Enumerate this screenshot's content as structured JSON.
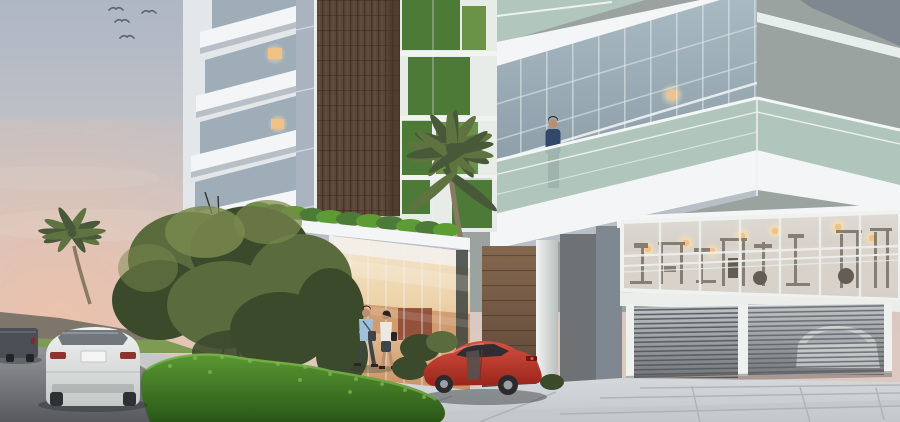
{
  "scene": {
    "type": "architectural-render",
    "setting": "modern residential building exterior at dusk",
    "objects": [
      "sky",
      "birds",
      "white-balcony-tower",
      "wood-clad-tower",
      "vertical-garden-panels",
      "glass-curtain-wall",
      "green-glass-balconies",
      "man-on-balcony",
      "palm-trees",
      "entrance-canopy-green-roof",
      "glass-lobby",
      "pedestrian-couple",
      "red-sports-car",
      "gym-window",
      "garage-shutter",
      "white-suv",
      "dark-van",
      "hedge",
      "trees",
      "road",
      "plaza-paving"
    ],
    "counts": {
      "birds": 4,
      "pedestrians": 2,
      "balcony_occupants": 1,
      "vehicles": 4
    }
  },
  "colors": {
    "sky_top": "#aeb7c4",
    "sky_mid": "#c6c5c8",
    "sky_horizon": "#ddc9c0",
    "sunset_pink": "#eec0a8",
    "bird": "#5a6470",
    "hills": "#6b685e",
    "grass": "#7d9b52",
    "lawn": "#76944c",
    "road_light": "#96979b",
    "road_dark": "#57595d",
    "sidewalk": "#c6c9cc",
    "plaza_light": "#d8dbde",
    "plaza_dark": "#c3c7cc",
    "paving_joint": "#a9aeb2",
    "facade_white": "#e3e7ea",
    "slab_white": "#f3f5f6",
    "slab_shadow": "#b9bfc7",
    "facade_side": "#aab4c0",
    "window_glass": "#9fadb9",
    "warm_light": "#f2c186",
    "light_glow": "#ffe2a8",
    "wood_dark": "#46352a",
    "wood_mid": "#5c4637",
    "wood_light": "#84674f",
    "green_wall": "#4e7a38",
    "green_wall_light": "#6a9348",
    "balcony_glass": "#b5cdc2",
    "rail_white": "#f5f7f6",
    "wall_gray": "#9aa39f",
    "wall_gray_dark": "#8f9794",
    "corner_gray": "#7f8890",
    "dark_wall": "#6e7275",
    "curtain_top": "#a9b9c2",
    "curtain_bottom": "#8d9da8",
    "gym_top": "#dfdbd4",
    "gym_bottom": "#c7c2ba",
    "equipment": "#7d756b",
    "equipment_dark": "#645d54",
    "shutter_light": "#c3c6c9",
    "shutter_dark": "#74787b",
    "slat_line": "#565a5e",
    "lobby_top": "#f5e8d2",
    "lobby_mid": "#ecd2a8",
    "lobby_bottom": "#c98f62",
    "lobby_red": "#8a4434",
    "hedge_light": "#5d9c33",
    "hedge_dark": "#2a5718",
    "hedge_highlight": "#86bf55",
    "tree_dark": "#3c4a2c",
    "tree_mid": "#5a6b3e",
    "tree_light": "#79894e",
    "palm_green": "#5f7340",
    "palm_dark": "#48593a",
    "trunk": "#8a7a63",
    "car_red_light": "#da5240",
    "car_red_dark": "#96231a",
    "car_glass": "#2f2f33",
    "suv_light": "#f0f2f1",
    "suv_dark": "#c5c9c8",
    "tail_red": "#8d3430",
    "van": "#4b4f55",
    "skin": "#b98e71",
    "hair": "#2a2522",
    "shirt_blue": "#9fc0d8",
    "shirt_navy": "#31486b",
    "top_white": "#ece9e4",
    "pants_dark": "#3f444b",
    "shadow": "#33373a"
  }
}
